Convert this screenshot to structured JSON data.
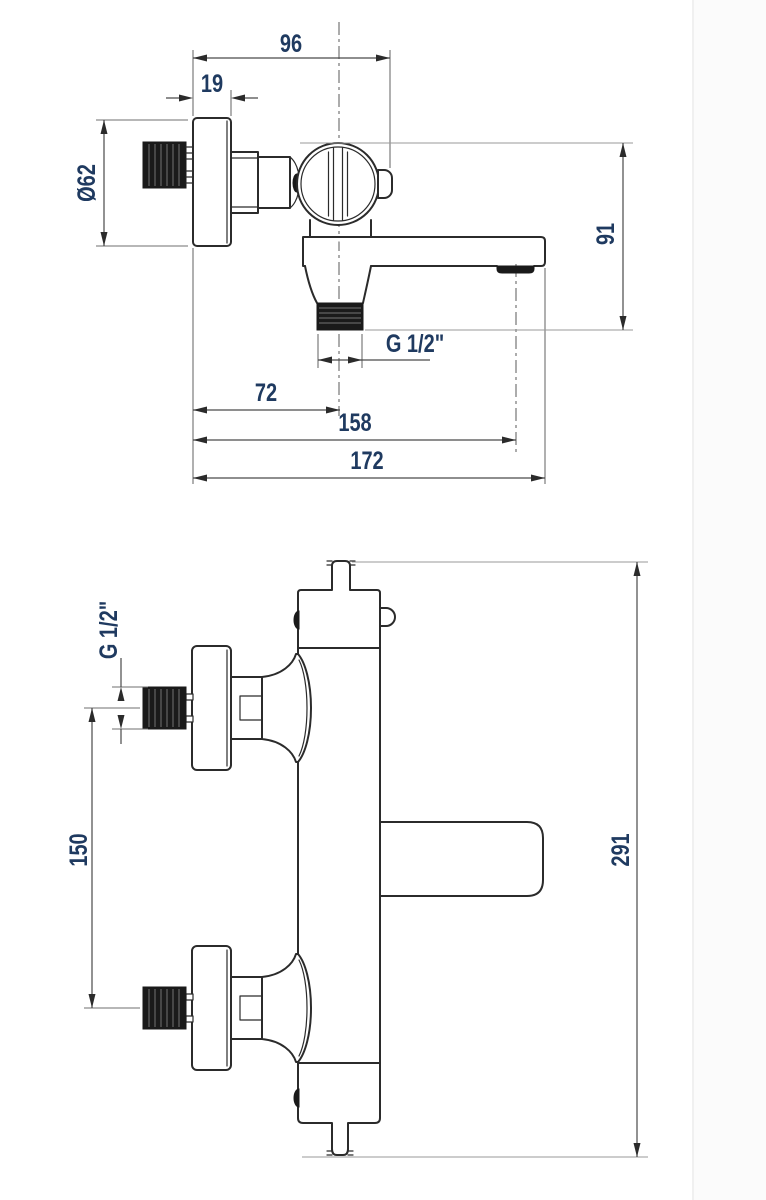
{
  "page": {
    "background": "#ffffff",
    "seam_color": "#ececec"
  },
  "drawing_style": {
    "outline_color": "#2b2b2b",
    "dimension_line_color": "#4a4a4a",
    "extension_line_color": "#9a9a9a",
    "dimension_text_color": "#1f3a60",
    "thread_fill_color": "#1a1a1a"
  },
  "side_view": {
    "dim_wall_to_handle_front": "96",
    "dim_escutcheon_depth": "19",
    "dim_escutcheon_diameter": "Ø62",
    "dim_handle_top_to_outlet": "91",
    "dim_outlet_thread": "G 1/2\"",
    "dim_wall_to_outlet_axis": "72",
    "dim_wall_to_aerator_axis": "158",
    "dim_wall_to_spout_tip": "172"
  },
  "front_view": {
    "dim_inlet_thread": "G 1/2\"",
    "dim_inlet_spacing": "150",
    "dim_total_height": "291"
  }
}
